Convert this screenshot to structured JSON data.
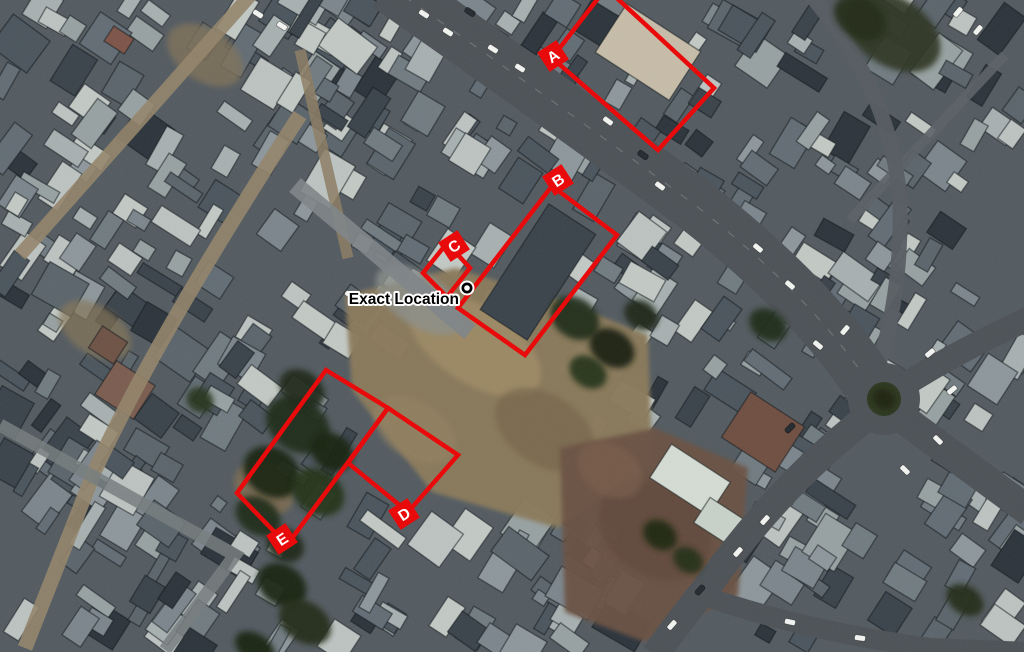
{
  "image": {
    "kind": "annotated-satellite-photo",
    "width": 1024,
    "height": 652
  },
  "colors": {
    "annotation_red": "#e90b0b",
    "label_letter": "#ffffff",
    "marker_ring": "#000000",
    "marker_fill": "#ffffff",
    "location_text": "#000000",
    "location_text_halo": "#ffffff"
  },
  "annotations": {
    "stroke_width": 4.5,
    "label_box_size": 23,
    "label_font_size": 15.5,
    "boxes": [
      {
        "label": "A",
        "points": [
          [
            552,
            58
          ],
          [
            606,
            -12
          ],
          [
            714,
            88
          ],
          [
            658,
            150
          ]
        ],
        "label_pos": {
          "x": 553,
          "y": 56
        },
        "label_rotation": -33
      },
      {
        "label": "B",
        "points": [
          [
            552,
            186
          ],
          [
            617,
            235
          ],
          [
            525,
            355
          ],
          [
            458,
            308
          ]
        ],
        "label_pos": {
          "x": 558,
          "y": 180
        },
        "label_rotation": -33
      },
      {
        "label": "C",
        "points": [
          [
            447,
            243
          ],
          [
            470,
            268
          ],
          [
            447,
            297
          ],
          [
            423,
            273
          ]
        ],
        "label_pos": {
          "x": 454,
          "y": 246
        },
        "label_rotation": -33
      },
      {
        "label": "D",
        "points": [
          [
            388,
            408
          ],
          [
            458,
            455
          ],
          [
            408,
            512
          ],
          [
            348,
            463
          ]
        ],
        "label_pos": {
          "x": 404,
          "y": 514
        },
        "label_rotation": -33
      },
      {
        "label": "E",
        "points": [
          [
            326,
            370
          ],
          [
            388,
            408
          ],
          [
            287,
            545
          ],
          [
            237,
            493
          ]
        ],
        "label_pos": {
          "x": 282,
          "y": 539
        },
        "label_rotation": -33
      }
    ],
    "marker": {
      "label": "Exact Location",
      "x": 467,
      "y": 288,
      "halo_radius": 7.5,
      "ring_radius": 5.5,
      "dot_radius": 2.8,
      "text_anchor_x": 459,
      "text_baseline_y": 304,
      "font_size": 15.5,
      "halo_stroke_width": 4
    }
  }
}
